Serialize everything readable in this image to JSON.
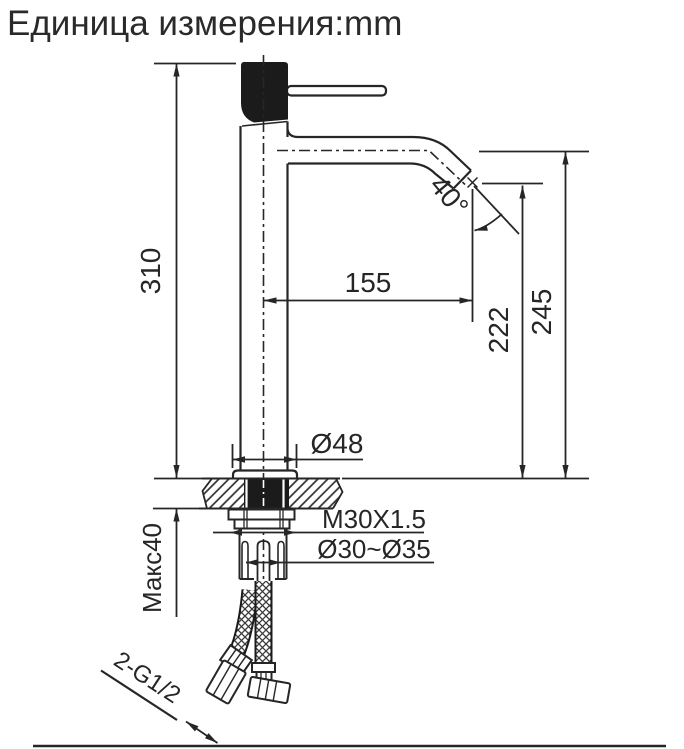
{
  "title": "Единица измерения:mm",
  "colors": {
    "line": "#262626",
    "black_fill": "#1b1b1b",
    "background": "#ffffff"
  },
  "drawing": {
    "labels": {
      "height_total": "310",
      "spout_reach": "155",
      "outlet_height": "222",
      "spout_height": "245",
      "spout_angle": "40°",
      "base_diameter": "Ø48",
      "mounting_thread": "M30X1.5",
      "mounting_hole_diameter": "Ø30~Ø35",
      "max_deck_thickness": "Макс40",
      "hose_connection": "2-G1/2"
    }
  }
}
